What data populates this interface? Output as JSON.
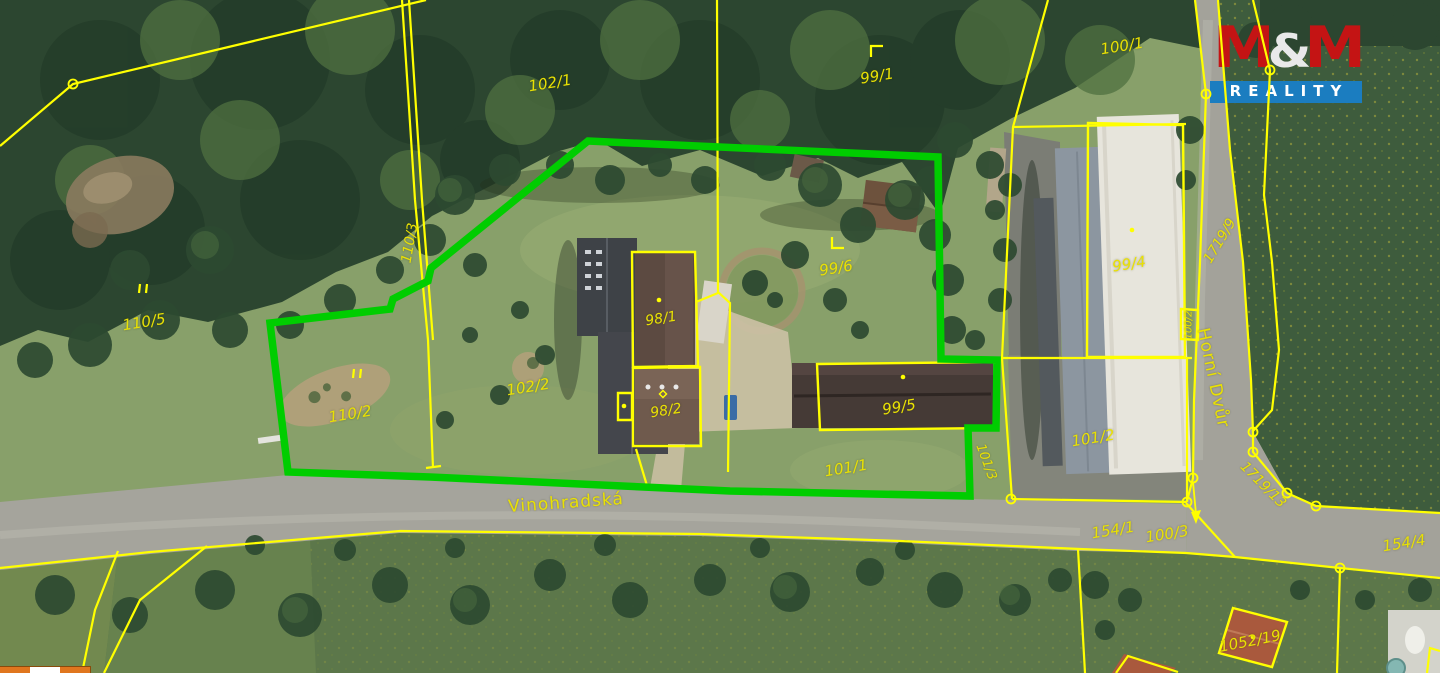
{
  "branding": {
    "m1": "M",
    "amp": "&",
    "m2": "M",
    "word": "REALITY",
    "logo_red": "#c41414",
    "logo_blue": "#1b7dc0"
  },
  "colors": {
    "boundary_green": "#00cd00",
    "cadastre_yellow": "#ffff00",
    "label_yellow": "#e9e104"
  },
  "streets": [
    {
      "name": "Vinohradská"
    },
    {
      "name": "Horní Dvůr"
    }
  ],
  "labels": [
    {
      "text": "102/1",
      "x": 550,
      "y": 83,
      "rot": -9,
      "fs": 15
    },
    {
      "text": "99/1",
      "x": 877,
      "y": 76,
      "rot": -9,
      "fs": 15
    },
    {
      "text": "100/1",
      "x": 1122,
      "y": 46,
      "rot": -9,
      "fs": 15
    },
    {
      "text": "110/3",
      "x": 410,
      "y": 243,
      "rot": -80,
      "fs": 14
    },
    {
      "text": "110/5",
      "x": 144,
      "y": 322,
      "rot": -9,
      "fs": 15
    },
    {
      "text": "110/2",
      "x": 350,
      "y": 414,
      "rot": -9,
      "fs": 15
    },
    {
      "text": "102/2",
      "x": 528,
      "y": 387,
      "rot": -9,
      "fs": 15
    },
    {
      "text": "98/1",
      "x": 661,
      "y": 319,
      "rot": -9,
      "fs": 14
    },
    {
      "text": "98/2",
      "x": 666,
      "y": 411,
      "rot": -9,
      "fs": 14
    },
    {
      "text": "99/6",
      "x": 836,
      "y": 268,
      "rot": -9,
      "fs": 15
    },
    {
      "text": "99/4",
      "x": 1129,
      "y": 264,
      "rot": -9,
      "fs": 15
    },
    {
      "text": "99/5",
      "x": 899,
      "y": 407,
      "rot": -9,
      "fs": 15
    },
    {
      "text": "101/1",
      "x": 846,
      "y": 468,
      "rot": -9,
      "fs": 15
    },
    {
      "text": "101/2",
      "x": 1093,
      "y": 438,
      "rot": -9,
      "fs": 15
    },
    {
      "text": "101/3",
      "x": 986,
      "y": 462,
      "rot": 70,
      "fs": 13
    },
    {
      "text": "100/3",
      "x": 1167,
      "y": 534,
      "rot": -9,
      "fs": 15
    },
    {
      "text": "154/1",
      "x": 1113,
      "y": 530,
      "rot": -9,
      "fs": 15
    },
    {
      "text": "154/4",
      "x": 1404,
      "y": 543,
      "rot": -9,
      "fs": 15
    },
    {
      "text": "1052/19",
      "x": 1250,
      "y": 641,
      "rot": -11,
      "fs": 15
    },
    {
      "text": "100/2",
      "x": 1189,
      "y": 325,
      "rot": -90,
      "fs": 10
    },
    {
      "text": "1719/9",
      "x": 1220,
      "y": 241,
      "rot": -59,
      "fs": 14
    },
    {
      "text": "1719/13",
      "x": 1263,
      "y": 485,
      "rot": 45,
      "fs": 14
    },
    {
      "text": "Vinohradská",
      "x": 566,
      "y": 503,
      "rot": -4,
      "fs": 17,
      "cls": "street"
    },
    {
      "text": "Horní Dvůr",
      "x": 1213,
      "y": 378,
      "rot": 78,
      "fs": 17,
      "cls": "street"
    }
  ],
  "scale_bar": {
    "segments": [
      "#e0761e",
      "#ffffff",
      "#e0761e"
    ]
  }
}
